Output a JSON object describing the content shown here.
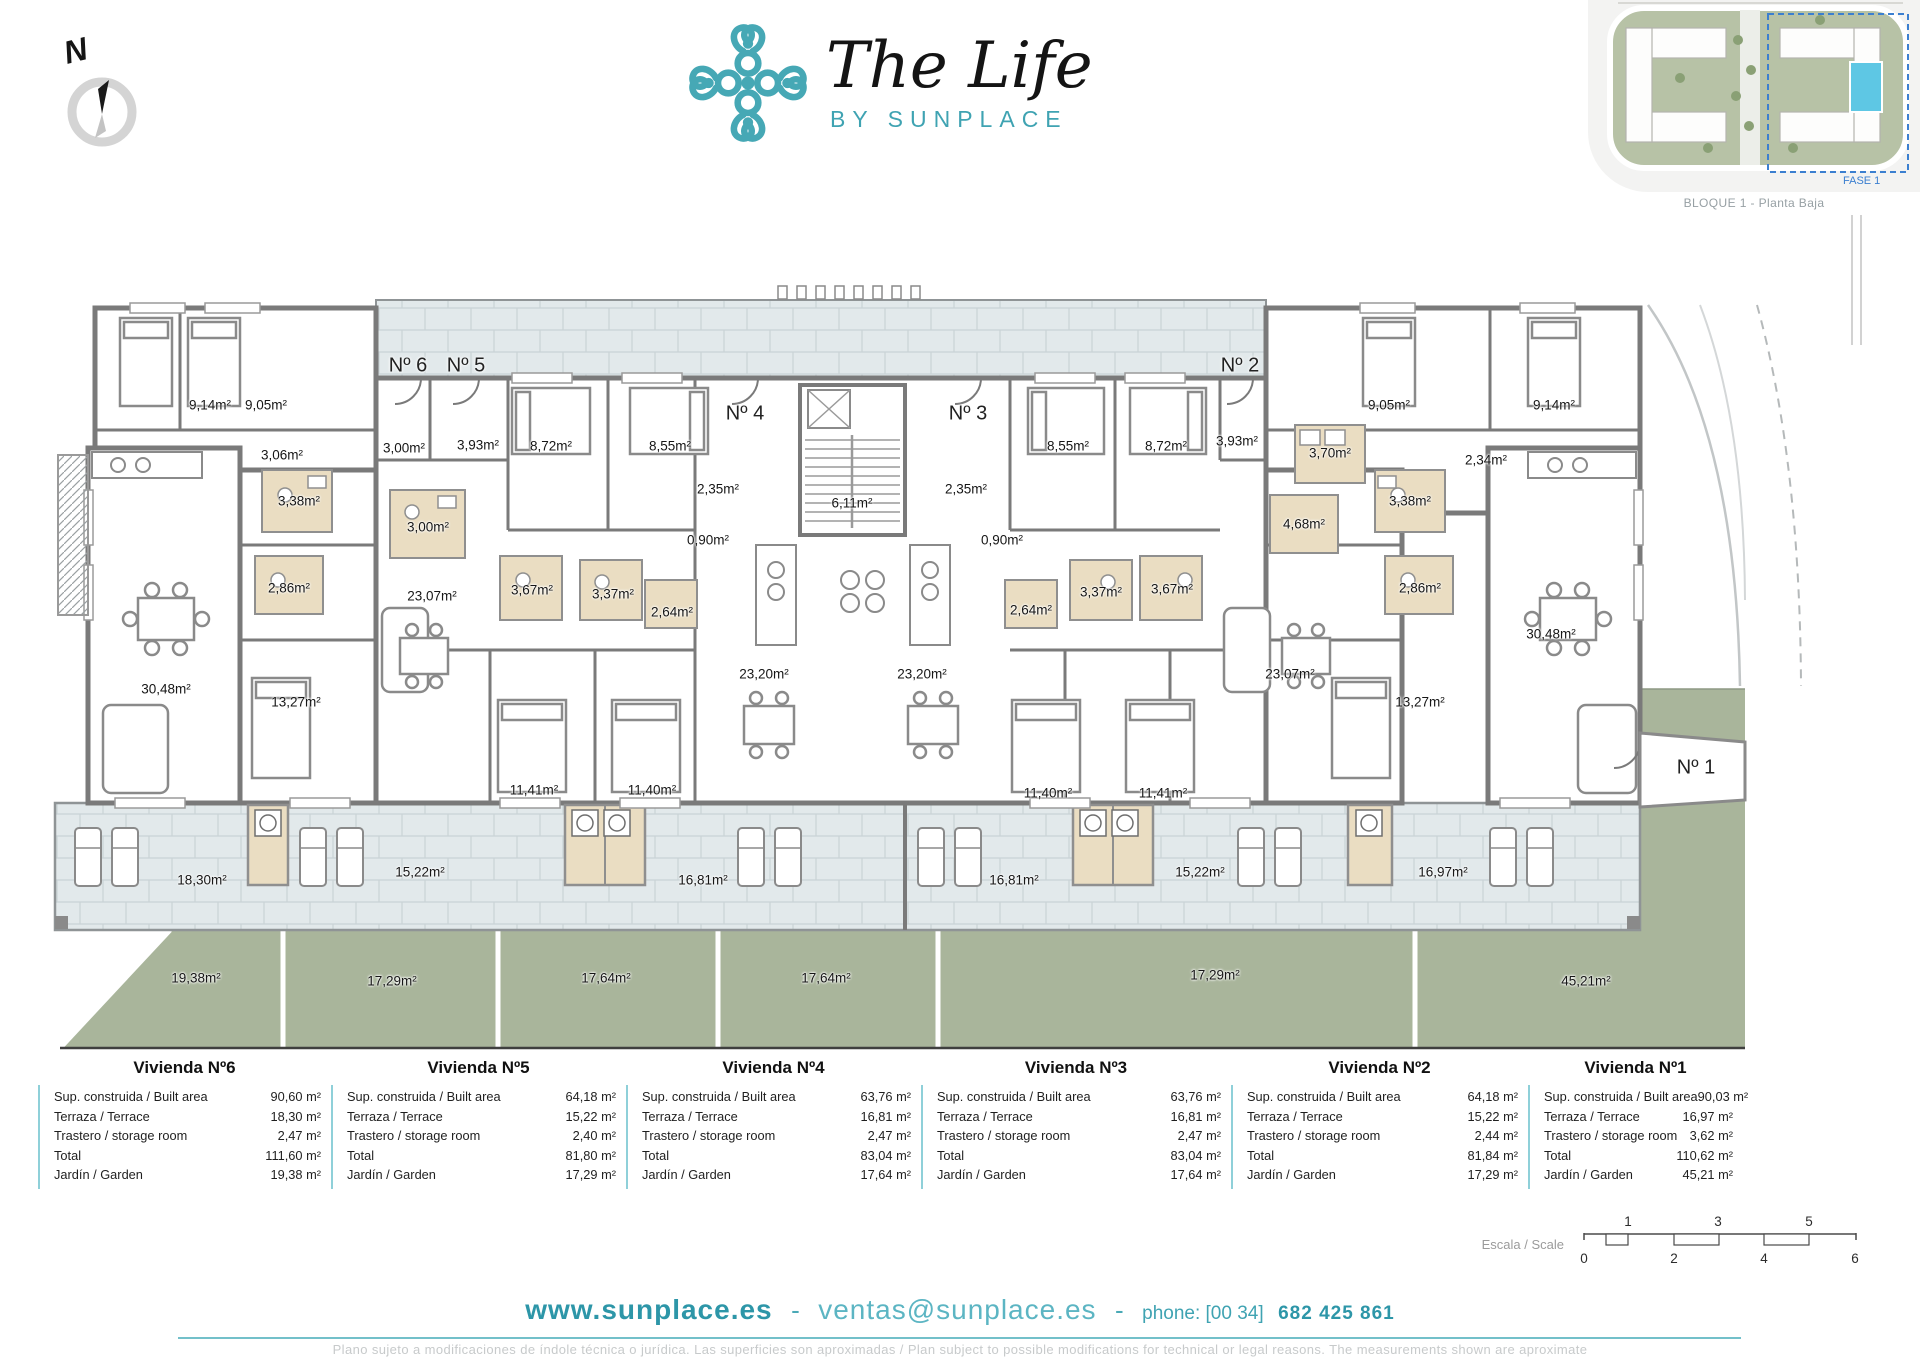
{
  "brand": {
    "name": "The Life",
    "subtitle": "BY SUNPLACE"
  },
  "compass": {
    "label": "N"
  },
  "site_plan": {
    "caption": "BLOQUE 1 - Planta Baja",
    "fase": "FASE 1"
  },
  "colors": {
    "teal": "#3fa3b2",
    "garden_green": "#a9b59b",
    "terrace_gray": "#e2e9eb",
    "bath_beige": "#eaddc2",
    "wall_gray": "#7a7a7a"
  },
  "plan": {
    "entry_labels": [
      {
        "t": "Nº 6",
        "x": 408,
        "y": 366
      },
      {
        "t": "Nº 5",
        "x": 466,
        "y": 366
      },
      {
        "t": "Nº 4",
        "x": 745,
        "y": 414
      },
      {
        "t": "Nº 3",
        "x": 968,
        "y": 414
      },
      {
        "t": "Nº 2",
        "x": 1240,
        "y": 366
      },
      {
        "t": "Nº 1",
        "x": 1696,
        "y": 768
      }
    ],
    "room_labels": [
      {
        "t": "9,14m²",
        "x": 210,
        "y": 405
      },
      {
        "t": "9,05m²",
        "x": 266,
        "y": 405
      },
      {
        "t": "3,06m²",
        "x": 282,
        "y": 455
      },
      {
        "t": "3,00m²",
        "x": 404,
        "y": 448
      },
      {
        "t": "3,93m²",
        "x": 478,
        "y": 445
      },
      {
        "t": "3,38m²",
        "x": 299,
        "y": 501
      },
      {
        "t": "2,86m²",
        "x": 289,
        "y": 588
      },
      {
        "t": "30,48m²",
        "x": 166,
        "y": 689
      },
      {
        "t": "13,27m²",
        "x": 296,
        "y": 702
      },
      {
        "t": "3,00m²",
        "x": 428,
        "y": 527
      },
      {
        "t": "8,72m²",
        "x": 551,
        "y": 446
      },
      {
        "t": "8,55m²",
        "x": 670,
        "y": 446
      },
      {
        "t": "23,07m²",
        "x": 432,
        "y": 596
      },
      {
        "t": "3,67m²",
        "x": 532,
        "y": 590
      },
      {
        "t": "3,37m²",
        "x": 613,
        "y": 594
      },
      {
        "t": "2,64m²",
        "x": 672,
        "y": 612
      },
      {
        "t": "11,41m²",
        "x": 534,
        "y": 790
      },
      {
        "t": "11,40m²",
        "x": 652,
        "y": 790
      },
      {
        "t": "2,35m²",
        "x": 718,
        "y": 489
      },
      {
        "t": "0,90m²",
        "x": 708,
        "y": 540
      },
      {
        "t": "6,11m²",
        "x": 852,
        "y": 503
      },
      {
        "t": "23,20m²",
        "x": 764,
        "y": 674
      },
      {
        "t": "23,20m²",
        "x": 922,
        "y": 674
      },
      {
        "t": "2,35m²",
        "x": 966,
        "y": 489
      },
      {
        "t": "0,90m²",
        "x": 1002,
        "y": 540
      },
      {
        "t": "8,55m²",
        "x": 1068,
        "y": 446
      },
      {
        "t": "8,72m²",
        "x": 1166,
        "y": 446
      },
      {
        "t": "2,64m²",
        "x": 1031,
        "y": 610
      },
      {
        "t": "3,37m²",
        "x": 1101,
        "y": 592
      },
      {
        "t": "3,67m²",
        "x": 1172,
        "y": 589
      },
      {
        "t": "11,40m²",
        "x": 1048,
        "y": 793
      },
      {
        "t": "11,41m²",
        "x": 1163,
        "y": 793
      },
      {
        "t": "3,93m²",
        "x": 1237,
        "y": 441
      },
      {
        "t": "3,70m²",
        "x": 1330,
        "y": 453
      },
      {
        "t": "4,68m²",
        "x": 1304,
        "y": 524
      },
      {
        "t": "23,07m²",
        "x": 1290,
        "y": 674
      },
      {
        "t": "9,05m²",
        "x": 1389,
        "y": 405
      },
      {
        "t": "9,14m²",
        "x": 1554,
        "y": 405
      },
      {
        "t": "2,34m²",
        "x": 1486,
        "y": 460
      },
      {
        "t": "3,38m²",
        "x": 1410,
        "y": 501
      },
      {
        "t": "2,86m²",
        "x": 1420,
        "y": 588
      },
      {
        "t": "13,27m²",
        "x": 1420,
        "y": 702
      },
      {
        "t": "30,48m²",
        "x": 1551,
        "y": 634
      },
      {
        "t": "18,30m²",
        "x": 202,
        "y": 880
      },
      {
        "t": "15,22m²",
        "x": 420,
        "y": 872
      },
      {
        "t": "16,81m²",
        "x": 703,
        "y": 880
      },
      {
        "t": "16,81m²",
        "x": 1014,
        "y": 880
      },
      {
        "t": "15,22m²",
        "x": 1200,
        "y": 872
      },
      {
        "t": "16,97m²",
        "x": 1443,
        "y": 872
      },
      {
        "t": "19,38m²",
        "x": 196,
        "y": 978
      },
      {
        "t": "17,29m²",
        "x": 392,
        "y": 981
      },
      {
        "t": "17,64m²",
        "x": 606,
        "y": 978
      },
      {
        "t": "17,64m²",
        "x": 826,
        "y": 978
      },
      {
        "t": "17,29m²",
        "x": 1215,
        "y": 975
      },
      {
        "t": "45,21m²",
        "x": 1586,
        "y": 981
      }
    ]
  },
  "table_row_labels": {
    "built": "Sup. construida / Built area",
    "terrace": "Terraza / Terrace",
    "storage": "Trastero / storage room",
    "total": "Total",
    "garden": "Jardín / Garden"
  },
  "units": [
    {
      "name": "Vivienda Nº6",
      "built": "90,60 m²",
      "terrace": "18,30 m²",
      "storage": "2,47 m²",
      "total": "111,60 m²",
      "garden": "19,38 m²"
    },
    {
      "name": "Vivienda Nº5",
      "built": "64,18 m²",
      "terrace": "15,22 m²",
      "storage": "2,40 m²",
      "total": "81,80 m²",
      "garden": "17,29 m²"
    },
    {
      "name": "Vivienda Nº4",
      "built": "63,76 m²",
      "terrace": "16,81 m²",
      "storage": "2,47 m²",
      "total": "83,04 m²",
      "garden": "17,64 m²"
    },
    {
      "name": "Vivienda Nº3",
      "built": "63,76 m²",
      "terrace": "16,81 m²",
      "storage": "2,47 m²",
      "total": "83,04 m²",
      "garden": "17,64 m²"
    },
    {
      "name": "Vivienda Nº2",
      "built": "64,18 m²",
      "terrace": "15,22 m²",
      "storage": "2,44 m²",
      "total": "81,84 m²",
      "garden": "17,29 m²"
    },
    {
      "name": "Vivienda Nº1",
      "built": "90,03 m²",
      "terrace": "16,97 m²",
      "storage": "3,62 m²",
      "total": "110,62 m²",
      "garden": "45,21 m²"
    }
  ],
  "scale": {
    "label": "Escala / Scale",
    "top_ticks": [
      {
        "t": "1",
        "x": 45
      },
      {
        "t": "3",
        "x": 135
      },
      {
        "t": "5",
        "x": 226
      }
    ],
    "bottom_ticks": [
      {
        "t": "0",
        "x": 1
      },
      {
        "t": "2",
        "x": 91
      },
      {
        "t": "4",
        "x": 181
      },
      {
        "t": "6",
        "x": 272
      }
    ]
  },
  "footer": {
    "website": "www.sunplace.es",
    "sep": "-",
    "email": "ventas@sunplace.es",
    "phone_label": "phone: [00 34]",
    "phone_number": "682 425 861",
    "disclaimer": "Plano sujeto a modificaciones de índole técnica o jurídica. Las superficies son aproximadas / Plan subject to possible modifications for technical or legal reasons. The measurements shown are aproximate"
  }
}
